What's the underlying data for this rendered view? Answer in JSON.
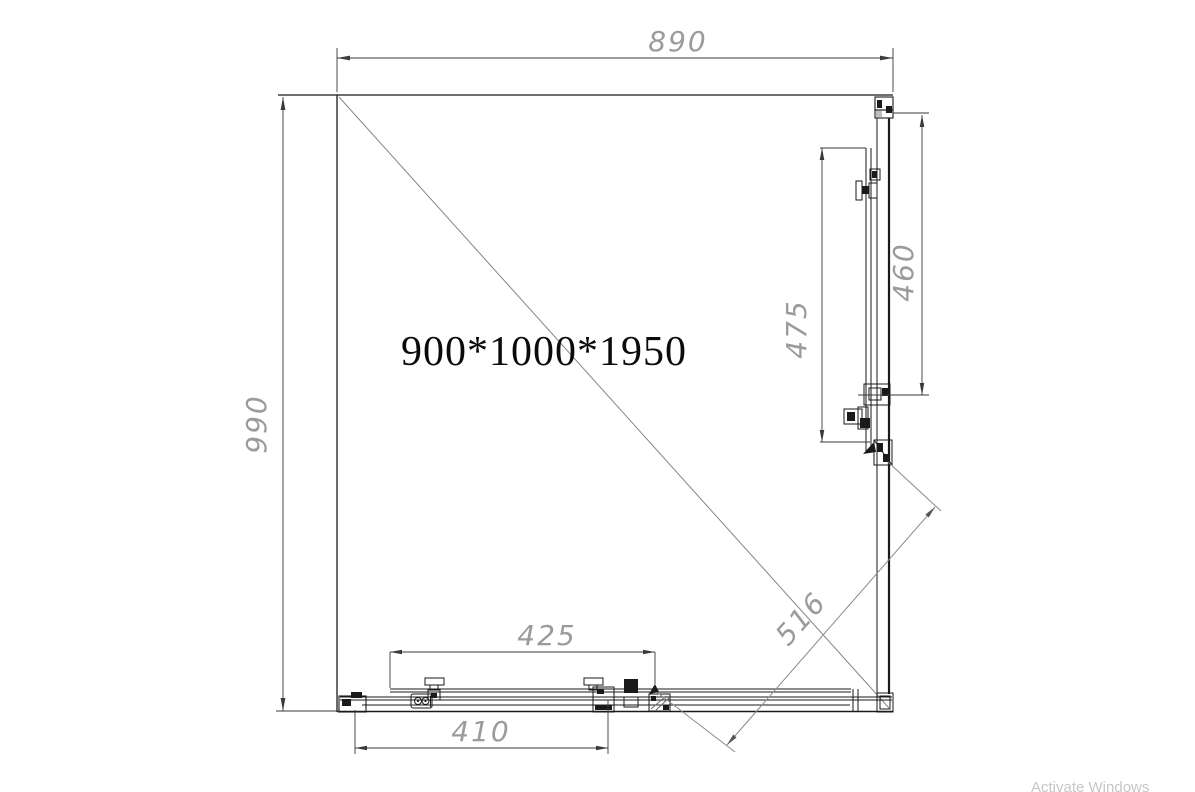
{
  "drawing": {
    "title": "900*1000*1950",
    "dims": {
      "top_width": "890",
      "left_height": "990",
      "right_panel_outer": "460",
      "right_panel_inner": "475",
      "bottom_panel_outer": "425",
      "bottom_panel_inner": "410",
      "diagonal_opening": "516"
    },
    "watermark": "Activate Windows",
    "colors": {
      "line": "#1a1a1a",
      "dimension_line": "#3a3a3a",
      "diagonal": "#858585",
      "dim_text": "#9b9b9b",
      "title_text": "#0b0b0b",
      "watermark": "#c6c6c6",
      "background": "#ffffff"
    }
  }
}
